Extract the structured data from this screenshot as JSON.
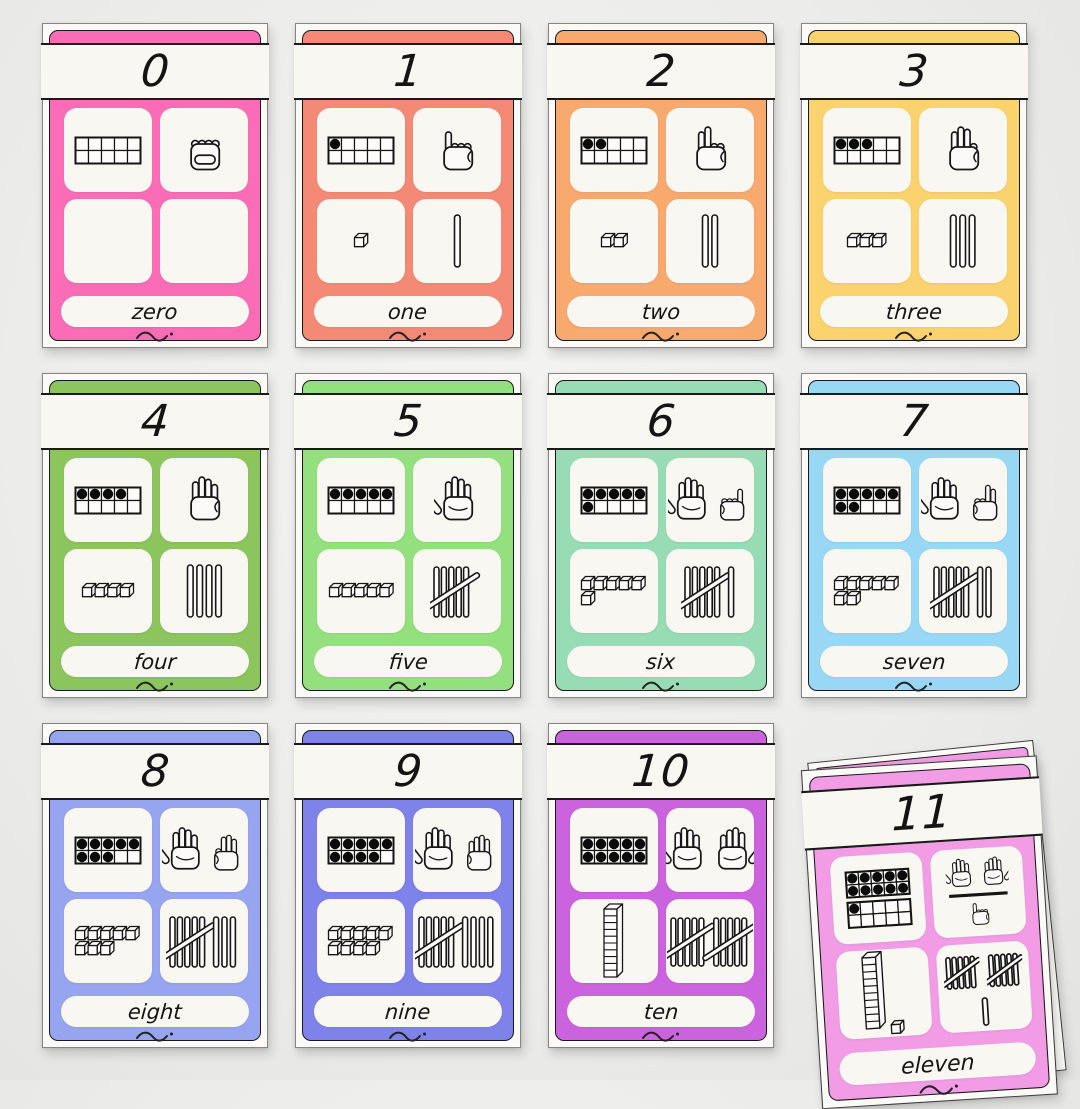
{
  "poster": {
    "kind": "number-flashcards",
    "visible_range": "0-11",
    "background_color": "#ececea",
    "paper_color": "#fbfaf6",
    "ink_color": "#141414"
  },
  "representations": [
    "ten-frame",
    "counting-hands-icon",
    "base-ten-blocks-icon",
    "tally-marks-icon"
  ],
  "cards": [
    {
      "numeral": "0",
      "word": "zero",
      "value": 0,
      "color": "#fa6db6"
    },
    {
      "numeral": "1",
      "word": "one",
      "value": 1,
      "color": "#f48a76"
    },
    {
      "numeral": "2",
      "word": "two",
      "value": 2,
      "color": "#f8a96e"
    },
    {
      "numeral": "3",
      "word": "three",
      "value": 3,
      "color": "#fad36e"
    },
    {
      "numeral": "4",
      "word": "four",
      "value": 4,
      "color": "#8cc45e"
    },
    {
      "numeral": "5",
      "word": "five",
      "value": 5,
      "color": "#94e07e"
    },
    {
      "numeral": "6",
      "word": "six",
      "value": 6,
      "color": "#97dcb4"
    },
    {
      "numeral": "7",
      "word": "seven",
      "value": 7,
      "color": "#99d8f5"
    },
    {
      "numeral": "8",
      "word": "eight",
      "value": 8,
      "color": "#97a5f0"
    },
    {
      "numeral": "9",
      "word": "nine",
      "value": 9,
      "color": "#7e82e9"
    },
    {
      "numeral": "10",
      "word": "ten",
      "value": 10,
      "color": "#cc63de"
    },
    {
      "numeral": "11",
      "word": "eleven",
      "value": 11,
      "color": "#f19ce5",
      "detached": true,
      "tilt_deg": -3.6
    }
  ]
}
